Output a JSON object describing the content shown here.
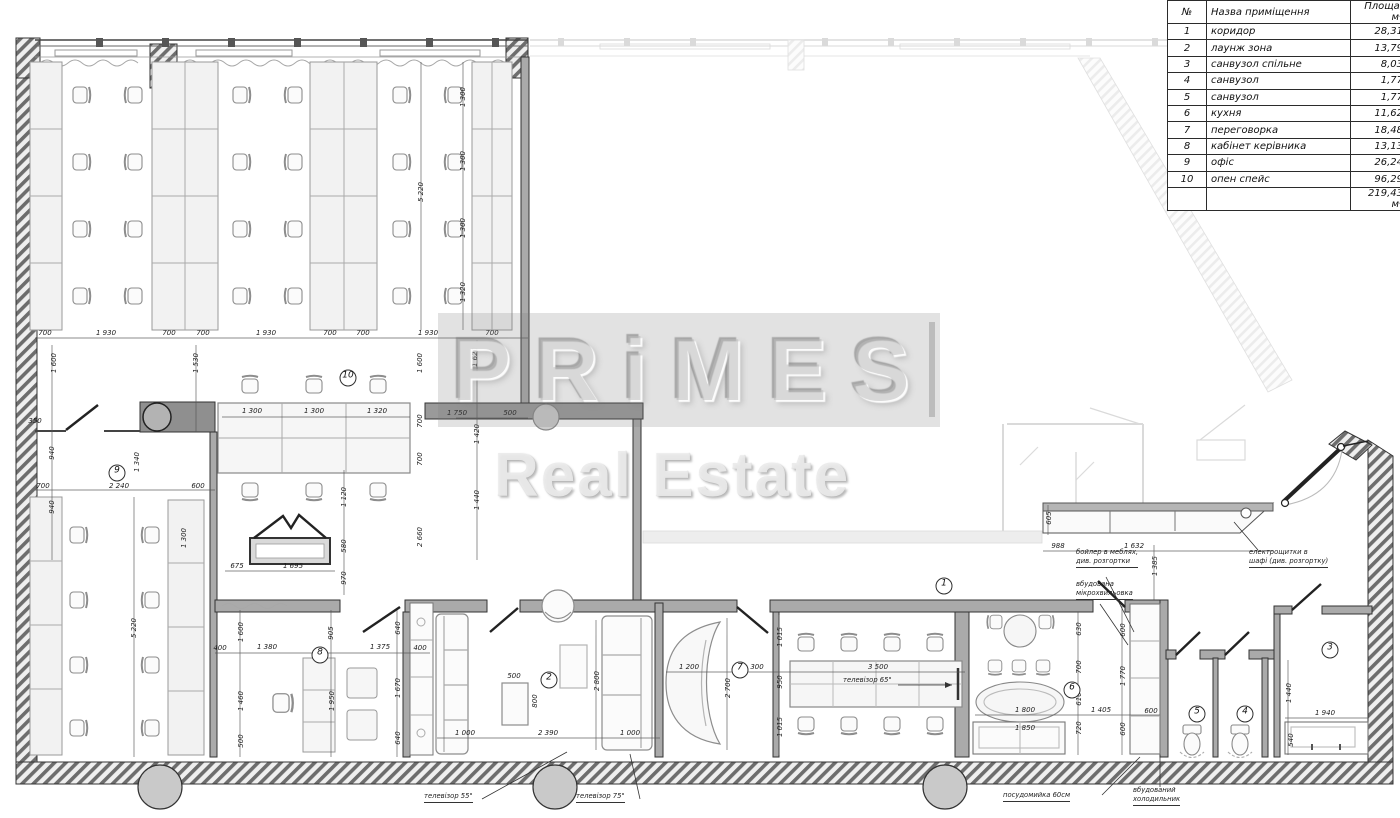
{
  "legend": {
    "headers": [
      "№",
      "Назва приміщення",
      "Площа, м²"
    ],
    "rows": [
      [
        "1",
        "коридор",
        "28,31"
      ],
      [
        "2",
        "лаунж зона",
        "13,79"
      ],
      [
        "3",
        "санвузол спільне",
        "8,03"
      ],
      [
        "4",
        "санвузол",
        "1,77"
      ],
      [
        "5",
        "санвузол",
        "1,77"
      ],
      [
        "6",
        "кухня",
        "11,62"
      ],
      [
        "7",
        "переговорка",
        "18,48"
      ],
      [
        "8",
        "кабінет керівника",
        "13,13"
      ],
      [
        "9",
        "офіс",
        "26,24"
      ],
      [
        "10",
        "опен спейс",
        "96,29"
      ]
    ],
    "total": "219,43 м²"
  },
  "watermark": {
    "line1": "PRiMES",
    "line2": "Real Estate"
  },
  "plan": {
    "room_markers": [
      {
        "n": "1",
        "x": 944,
        "y": 586
      },
      {
        "n": "2",
        "x": 549,
        "y": 680
      },
      {
        "n": "3",
        "x": 1330,
        "y": 650
      },
      {
        "n": "4",
        "x": 1245,
        "y": 714
      },
      {
        "n": "5",
        "x": 1197,
        "y": 714
      },
      {
        "n": "6",
        "x": 1072,
        "y": 690
      },
      {
        "n": "7",
        "x": 740,
        "y": 670
      },
      {
        "n": "8",
        "x": 320,
        "y": 655
      },
      {
        "n": "9",
        "x": 117,
        "y": 473
      },
      {
        "n": "10",
        "x": 348,
        "y": 378
      }
    ],
    "annotations": [
      {
        "t": "бойлер в меблях,\nдив. розгортки",
        "x": 1076,
        "y": 548,
        "u": true
      },
      {
        "t": "вбудована\nмікрохвильовка",
        "x": 1076,
        "y": 580,
        "u": true
      },
      {
        "t": "електрощитки в\nшафі (див. розгортку)",
        "x": 1249,
        "y": 548,
        "u": true
      },
      {
        "t": "посудомийка 60см",
        "x": 1003,
        "y": 791,
        "u": true
      },
      {
        "t": "вбудований\nхолодильник",
        "x": 1133,
        "y": 786,
        "u": true
      },
      {
        "t": "телевізор 55\"",
        "x": 424,
        "y": 792,
        "u": true
      },
      {
        "t": "телевізор 75\"",
        "x": 576,
        "y": 792,
        "u": true
      },
      {
        "t": "телевізор 65\"",
        "x": 843,
        "y": 676,
        "u": false
      }
    ],
    "dimensions": [
      {
        "t": "700",
        "x": 45,
        "y": 333
      },
      {
        "t": "1 930",
        "x": 106,
        "y": 333
      },
      {
        "t": "700",
        "x": 169,
        "y": 333
      },
      {
        "t": "700",
        "x": 203,
        "y": 333
      },
      {
        "t": "1 930",
        "x": 266,
        "y": 333
      },
      {
        "t": "700",
        "x": 330,
        "y": 333
      },
      {
        "t": "700",
        "x": 363,
        "y": 333
      },
      {
        "t": "1 930",
        "x": 428,
        "y": 333
      },
      {
        "t": "700",
        "x": 492,
        "y": 333
      },
      {
        "t": "1 600",
        "x": 54,
        "y": 363,
        "r": -90
      },
      {
        "t": "1 530",
        "x": 196,
        "y": 363,
        "r": -90
      },
      {
        "t": "350",
        "x": 35,
        "y": 421
      },
      {
        "t": "940",
        "x": 52,
        "y": 453,
        "r": -90
      },
      {
        "t": "940",
        "x": 52,
        "y": 507,
        "r": -90
      },
      {
        "t": "700",
        "x": 43,
        "y": 486
      },
      {
        "t": "2 240",
        "x": 119,
        "y": 486
      },
      {
        "t": "600",
        "x": 198,
        "y": 486
      },
      {
        "t": "1 300",
        "x": 463,
        "y": 97,
        "r": -90
      },
      {
        "t": "1 300",
        "x": 463,
        "y": 161,
        "r": -90
      },
      {
        "t": "1 300",
        "x": 463,
        "y": 228,
        "r": -90
      },
      {
        "t": "1 320",
        "x": 463,
        "y": 292,
        "r": -90
      },
      {
        "t": "5 220",
        "x": 421,
        "y": 192,
        "r": -90
      },
      {
        "t": "5 220",
        "x": 134,
        "y": 628,
        "r": -90
      },
      {
        "t": "1 300",
        "x": 184,
        "y": 538,
        "r": -90
      },
      {
        "t": "1 340",
        "x": 137,
        "y": 462,
        "r": -90
      },
      {
        "t": "1 300",
        "x": 252,
        "y": 411
      },
      {
        "t": "1 300",
        "x": 314,
        "y": 411
      },
      {
        "t": "1 320",
        "x": 377,
        "y": 411
      },
      {
        "t": "1 120",
        "x": 344,
        "y": 497,
        "r": -90
      },
      {
        "t": "580",
        "x": 344,
        "y": 546,
        "r": -90
      },
      {
        "t": "970",
        "x": 344,
        "y": 578,
        "r": -90
      },
      {
        "t": "675",
        "x": 237,
        "y": 566
      },
      {
        "t": "1 695",
        "x": 293,
        "y": 566
      },
      {
        "t": "1 600",
        "x": 420,
        "y": 363,
        "r": -90
      },
      {
        "t": "700",
        "x": 420,
        "y": 421,
        "r": -90
      },
      {
        "t": "700",
        "x": 420,
        "y": 459,
        "r": -90
      },
      {
        "t": "2 660",
        "x": 420,
        "y": 537,
        "r": -90
      },
      {
        "t": "1 620",
        "x": 475,
        "y": 357,
        "r": -90
      },
      {
        "t": "1 750",
        "x": 457,
        "y": 413
      },
      {
        "t": "500",
        "x": 510,
        "y": 413
      },
      {
        "t": "1 420",
        "x": 477,
        "y": 434,
        "r": -90
      },
      {
        "t": "1 440",
        "x": 477,
        "y": 500,
        "r": -90
      },
      {
        "t": "400",
        "x": 220,
        "y": 648
      },
      {
        "t": "1 380",
        "x": 267,
        "y": 647
      },
      {
        "t": "905",
        "x": 331,
        "y": 633,
        "r": -90
      },
      {
        "t": "1 375",
        "x": 380,
        "y": 647
      },
      {
        "t": "400",
        "x": 420,
        "y": 648
      },
      {
        "t": "1 600",
        "x": 241,
        "y": 632,
        "r": -90
      },
      {
        "t": "1 460",
        "x": 241,
        "y": 701,
        "r": -90
      },
      {
        "t": "500",
        "x": 241,
        "y": 741,
        "r": -90
      },
      {
        "t": "1 950",
        "x": 332,
        "y": 701,
        "r": -90
      },
      {
        "t": "640",
        "x": 398,
        "y": 628,
        "r": -90
      },
      {
        "t": "1 670",
        "x": 398,
        "y": 688,
        "r": -90
      },
      {
        "t": "640",
        "x": 398,
        "y": 738,
        "r": -90
      },
      {
        "t": "500",
        "x": 514,
        "y": 676
      },
      {
        "t": "800",
        "x": 535,
        "y": 701,
        "r": -90
      },
      {
        "t": "2 800",
        "x": 597,
        "y": 681,
        "r": -90
      },
      {
        "t": "1 000",
        "x": 465,
        "y": 733
      },
      {
        "t": "2 390",
        "x": 548,
        "y": 733
      },
      {
        "t": "1 000",
        "x": 630,
        "y": 733
      },
      {
        "t": "1 200",
        "x": 689,
        "y": 667
      },
      {
        "t": "300",
        "x": 757,
        "y": 667
      },
      {
        "t": "3 500",
        "x": 878,
        "y": 667
      },
      {
        "t": "2 700",
        "x": 728,
        "y": 688,
        "r": -90
      },
      {
        "t": "1 015",
        "x": 780,
        "y": 637,
        "r": -90
      },
      {
        "t": "950",
        "x": 780,
        "y": 682,
        "r": -90
      },
      {
        "t": "1 015",
        "x": 780,
        "y": 727,
        "r": -90
      },
      {
        "t": "630",
        "x": 1079,
        "y": 629,
        "r": -90
      },
      {
        "t": "700",
        "x": 1079,
        "y": 667,
        "r": -90
      },
      {
        "t": "610",
        "x": 1079,
        "y": 699,
        "r": -90
      },
      {
        "t": "720",
        "x": 1079,
        "y": 728,
        "r": -90
      },
      {
        "t": "1 800",
        "x": 1025,
        "y": 710
      },
      {
        "t": "1 850",
        "x": 1025,
        "y": 728
      },
      {
        "t": "1 405",
        "x": 1101,
        "y": 710
      },
      {
        "t": "600",
        "x": 1151,
        "y": 711
      },
      {
        "t": "600",
        "x": 1123,
        "y": 630,
        "r": -90
      },
      {
        "t": "1 770",
        "x": 1123,
        "y": 676,
        "r": -90
      },
      {
        "t": "600",
        "x": 1123,
        "y": 729,
        "r": -90
      },
      {
        "t": "1 440",
        "x": 1289,
        "y": 693,
        "r": -90
      },
      {
        "t": "1 940",
        "x": 1325,
        "y": 713
      },
      {
        "t": "540",
        "x": 1291,
        "y": 740,
        "r": -90
      },
      {
        "t": "605",
        "x": 1049,
        "y": 518,
        "r": -90
      },
      {
        "t": "988",
        "x": 1058,
        "y": 546
      },
      {
        "t": "1 632",
        "x": 1134,
        "y": 546
      },
      {
        "t": "1 385",
        "x": 1155,
        "y": 566,
        "r": -90
      }
    ]
  }
}
